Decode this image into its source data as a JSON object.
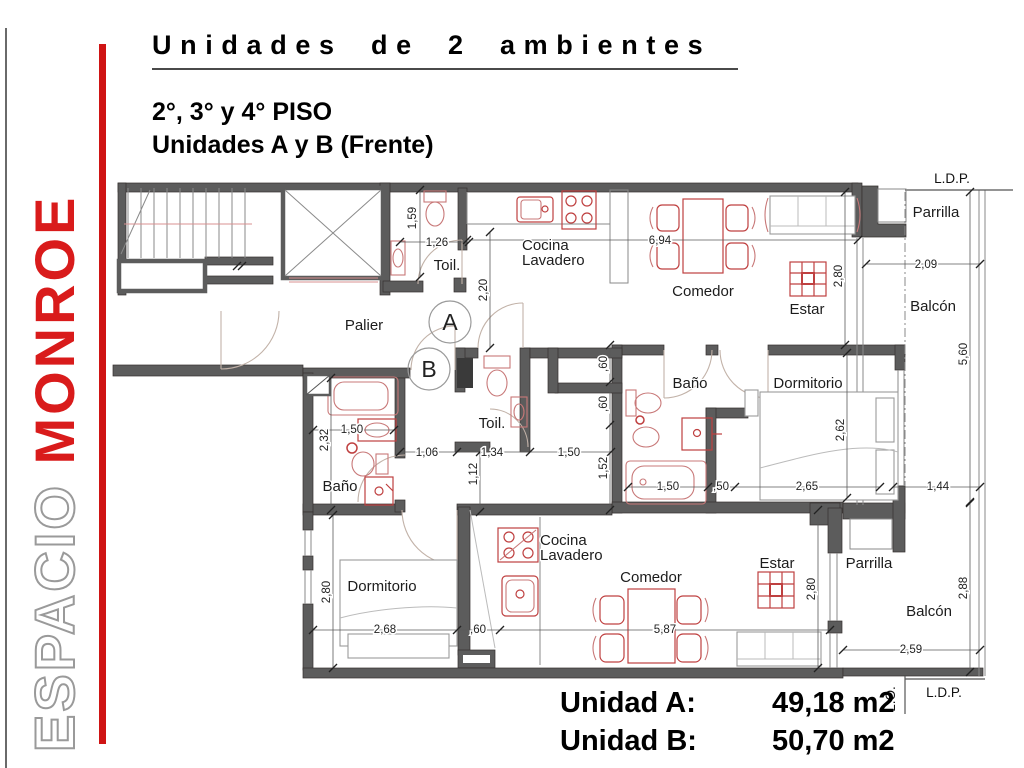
{
  "sidebar": {
    "brand_word_outline": "ESPACIO",
    "brand_word_solid": "MONROE",
    "accent_color": "#cf1414"
  },
  "header": {
    "title": "Unidades de 2 ambientes",
    "floors": "2°, 3° y 4° PISO",
    "units": "Unidades A y B (Frente)"
  },
  "summary": {
    "rows": [
      {
        "label": "Unidad A:",
        "value": "49,18 m2"
      },
      {
        "label": "Unidad B:",
        "value": "50,70 m2"
      }
    ]
  },
  "plan": {
    "unit_circles": [
      {
        "label": "A",
        "x": 450,
        "y": 322
      },
      {
        "label": "B",
        "x": 429,
        "y": 369
      }
    ],
    "rooms": [
      {
        "label": "Toil.",
        "x": 447,
        "y": 270
      },
      {
        "lines": [
          "Cocina",
          "Lavadero"
        ],
        "x": 522,
        "y": 250
      },
      {
        "label": "Comedor",
        "x": 703,
        "y": 296
      },
      {
        "label": "Estar",
        "x": 807,
        "y": 314
      },
      {
        "label": "Parrilla",
        "x": 936,
        "y": 217
      },
      {
        "label": "Balcón",
        "x": 933,
        "y": 311
      },
      {
        "label": "Palier",
        "x": 364,
        "y": 330
      },
      {
        "label": "Baño",
        "x": 690,
        "y": 388
      },
      {
        "label": "Dormitorio",
        "x": 808,
        "y": 388
      },
      {
        "label": "Toil.",
        "x": 492,
        "y": 428
      },
      {
        "label": "Baño",
        "x": 340,
        "y": 491
      },
      {
        "label": "Dormitorio",
        "x": 382,
        "y": 591
      },
      {
        "lines": [
          "Cocina",
          "Lavadero"
        ],
        "x": 540,
        "y": 545
      },
      {
        "label": "Comedor",
        "x": 651,
        "y": 582
      },
      {
        "label": "Estar",
        "x": 777,
        "y": 568
      },
      {
        "label": "Parrilla",
        "x": 869,
        "y": 568
      },
      {
        "label": "Balcón",
        "x": 929,
        "y": 616
      }
    ],
    "dimensions": [
      {
        "v": "1,59",
        "x": 416,
        "y": 218,
        "vert": true
      },
      {
        "v": "1,26",
        "x": 437,
        "y": 246
      },
      {
        "v": "2,20",
        "x": 487,
        "y": 290,
        "vert": true
      },
      {
        "v": "6,94",
        "x": 660,
        "y": 244
      },
      {
        "v": "2,80",
        "x": 842,
        "y": 276,
        "vert": true
      },
      {
        "v": "2,09",
        "x": 926,
        "y": 268
      },
      {
        "v": "5,60",
        "x": 967,
        "y": 354,
        "vert": true
      },
      {
        "v": ",60",
        "x": 607,
        "y": 364,
        "vert": true
      },
      {
        "v": ",60",
        "x": 607,
        "y": 404,
        "vert": true
      },
      {
        "v": "1,52",
        "x": 607,
        "y": 468,
        "vert": true
      },
      {
        "v": "1,06",
        "x": 427,
        "y": 456
      },
      {
        "v": "1,34",
        "x": 492,
        "y": 456
      },
      {
        "v": "1,50",
        "x": 569,
        "y": 456
      },
      {
        "v": "1,50",
        "x": 352,
        "y": 433
      },
      {
        "v": "2,32",
        "x": 328,
        "y": 440,
        "vert": true
      },
      {
        "v": "1,12",
        "x": 477,
        "y": 474,
        "vert": true
      },
      {
        "v": "1,50",
        "x": 668,
        "y": 490
      },
      {
        "v": ",50",
        "x": 721,
        "y": 490
      },
      {
        "v": "2,65",
        "x": 807,
        "y": 490
      },
      {
        "v": "1,44",
        "x": 938,
        "y": 490
      },
      {
        "v": "2,62",
        "x": 844,
        "y": 430,
        "vert": true
      },
      {
        "v": "2,80",
        "x": 330,
        "y": 592,
        "vert": true
      },
      {
        "v": "2,68",
        "x": 385,
        "y": 633
      },
      {
        "v": ",60",
        "x": 478,
        "y": 633
      },
      {
        "v": "5,87",
        "x": 665,
        "y": 633
      },
      {
        "v": "2,80",
        "x": 815,
        "y": 589,
        "vert": true
      },
      {
        "v": "2,59",
        "x": 911,
        "y": 653
      },
      {
        "v": "2,88",
        "x": 967,
        "y": 588,
        "vert": true
      }
    ],
    "boundaries": [
      {
        "label": "L.D.P.",
        "x": 952,
        "y": 183
      },
      {
        "label": "L.D.P.",
        "x": 944,
        "y": 697
      },
      {
        "label": "L.O.",
        "x": 895,
        "y": 699,
        "vert": true
      }
    ]
  }
}
